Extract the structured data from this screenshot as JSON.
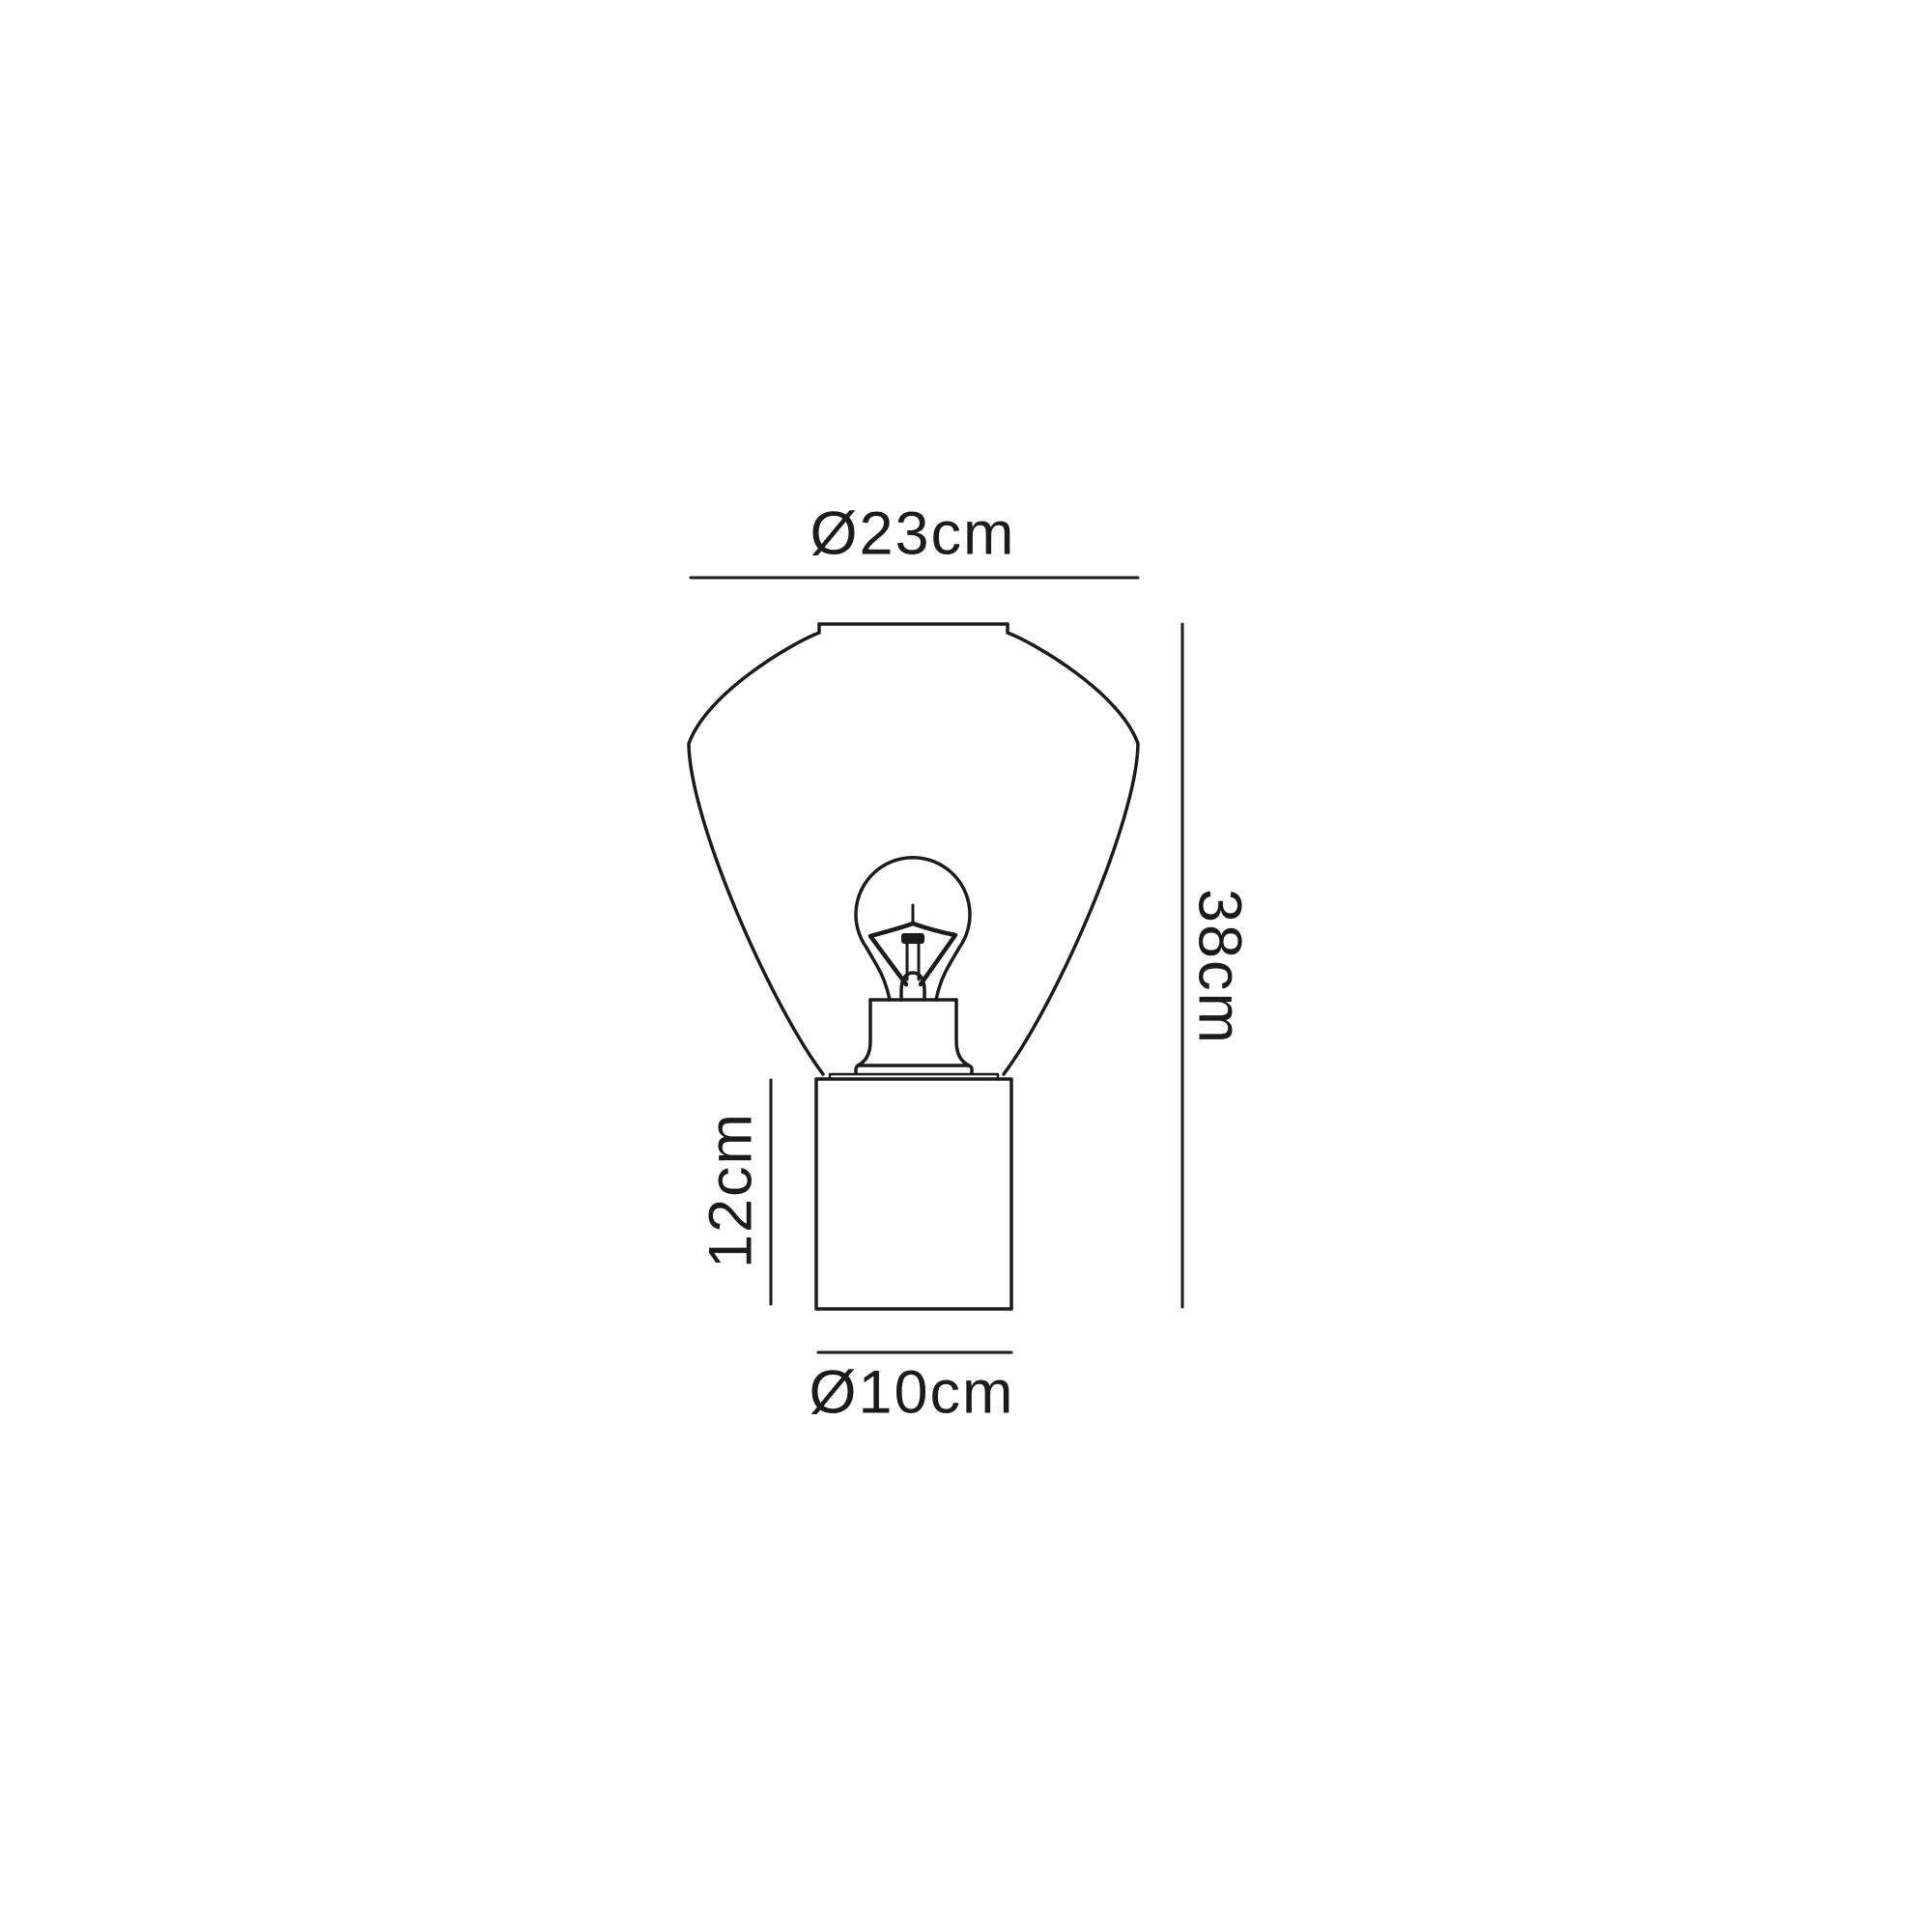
{
  "diagram": {
    "kind": "product-dimension-line-drawing",
    "subject": "table lamp with exposed bulb, flared shade and cylindrical base",
    "background_color": "#ffffff",
    "line_color": "#1b1b1b",
    "dimensions": {
      "shade_diameter": {
        "label": "Ø23cm",
        "position": "top"
      },
      "total_height": {
        "label": "38cm",
        "position": "right"
      },
      "base_height": {
        "label": "12cm",
        "position": "left"
      },
      "base_diameter": {
        "label": "Ø10cm",
        "position": "bottom"
      }
    }
  }
}
